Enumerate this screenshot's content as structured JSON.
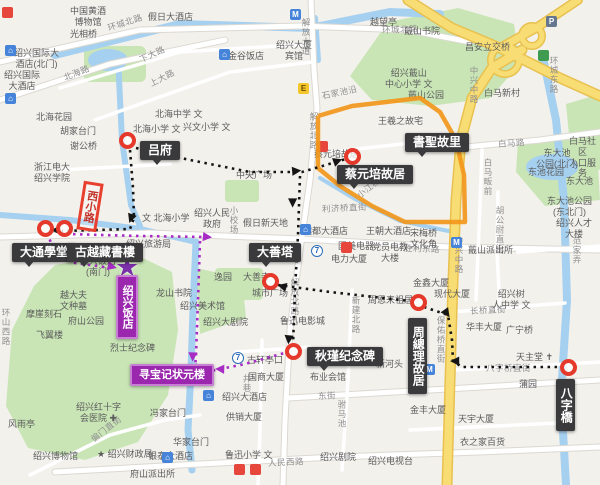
{
  "map": {
    "colors": {
      "land": "#F3F1EC",
      "park": "#C9E5B6",
      "water": "#A6D0F0",
      "road_yellow": "#F8DC74",
      "route_orange": "#F2971B",
      "route_black": "#151515",
      "route_purple": "#A62CC4",
      "marker_red": "#E5392B",
      "label_black_bg": "#3A3A3C",
      "label_purple_bg": "#9A27AE"
    },
    "streets": [
      {
        "t": "环城北路",
        "x": 108,
        "y": 22,
        "r": -18
      },
      {
        "t": "环城北路",
        "x": 382,
        "y": 24,
        "r": -2
      },
      {
        "t": "北海路",
        "x": 64,
        "y": 72,
        "r": -22
      },
      {
        "t": "下大路",
        "x": 140,
        "y": 54,
        "r": -25
      },
      {
        "t": "上大路",
        "x": 150,
        "y": 78,
        "r": -27
      },
      {
        "t": "解放大道",
        "x": 300,
        "y": 18,
        "v": 1
      },
      {
        "t": "解放北路",
        "x": 308,
        "y": 112,
        "v": 1
      },
      {
        "t": "解放北路",
        "x": 289,
        "y": 278,
        "v": 1
      },
      {
        "t": "中兴中路",
        "x": 468,
        "y": 66,
        "v": 1
      },
      {
        "t": "中兴中路",
        "x": 453,
        "y": 236,
        "v": 1
      },
      {
        "t": "环城东路",
        "x": 548,
        "y": 56,
        "v": 1
      },
      {
        "t": "白马路",
        "x": 498,
        "y": 138,
        "r": -4
      },
      {
        "t": "石家池沿",
        "x": 322,
        "y": 90,
        "r": -12
      },
      {
        "t": "小江桥河沿",
        "x": 358,
        "y": 190,
        "r": -38
      },
      {
        "t": "利济桥直街",
        "x": 322,
        "y": 203,
        "r": -3
      },
      {
        "t": "胜利东路",
        "x": 404,
        "y": 242,
        "r": 2
      },
      {
        "t": "东街",
        "x": 318,
        "y": 390,
        "r": -2
      },
      {
        "t": "八字桥直街",
        "x": 486,
        "y": 362,
        "r": 0
      },
      {
        "t": "长桥直街",
        "x": 470,
        "y": 305,
        "r": -3
      },
      {
        "t": "人民西路",
        "x": 268,
        "y": 457,
        "r": -3
      },
      {
        "t": "偏门直街",
        "x": 92,
        "y": 434,
        "r": -38
      },
      {
        "t": "白马畈前",
        "x": 482,
        "y": 158,
        "v": 1
      },
      {
        "t": "胡公尉直街",
        "x": 494,
        "y": 206,
        "v": 1
      },
      {
        "t": "新建北路",
        "x": 350,
        "y": 296,
        "v": 1
      },
      {
        "t": "保佑桥直街",
        "x": 435,
        "y": 316,
        "v": 1
      },
      {
        "t": "井巷",
        "x": 241,
        "y": 374,
        "v": 1
      },
      {
        "t": "小校场",
        "x": 228,
        "y": 206,
        "v": 1
      },
      {
        "t": "环山西路",
        "x": 0,
        "y": 308,
        "v": 1
      },
      {
        "t": "驸马池",
        "x": 336,
        "y": 400,
        "v": 1
      },
      {
        "t": "范家弄",
        "x": 571,
        "y": 236,
        "v": 1
      }
    ],
    "pois": [
      {
        "t": "中国黄酒\n博物馆",
        "x": 70,
        "y": 6
      },
      {
        "t": "假日大酒店",
        "x": 148,
        "y": 12
      },
      {
        "t": "光相桥",
        "x": 70,
        "y": 29
      },
      {
        "t": "绍兴国际大\n酒店(北门)",
        "x": 14,
        "y": 48
      },
      {
        "t": "绍兴国际\n大酒店",
        "x": 4,
        "y": 70
      },
      {
        "t": "北海花园",
        "x": 36,
        "y": 112
      },
      {
        "t": "胡家台门",
        "x": 60,
        "y": 126
      },
      {
        "t": "谢公桥",
        "x": 70,
        "y": 141
      },
      {
        "t": "北海中学 文",
        "x": 155,
        "y": 109
      },
      {
        "t": "北海小学 文",
        "x": 133,
        "y": 124
      },
      {
        "t": "兴文小学 文",
        "x": 183,
        "y": 122
      },
      {
        "t": "浙江电大\n绍兴学院",
        "x": 34,
        "y": 162
      },
      {
        "t": "金谷饭店",
        "x": 228,
        "y": 51
      },
      {
        "t": "绍兴大厦\n宾馆",
        "x": 276,
        "y": 40
      },
      {
        "t": "越望亭",
        "x": 370,
        "y": 17
      },
      {
        "t": "绍兴蕺山\n中心小学 文",
        "x": 385,
        "y": 68
      },
      {
        "t": "蕺山书院",
        "x": 404,
        "y": 26
      },
      {
        "t": "蕺山公园",
        "x": 408,
        "y": 90
      },
      {
        "t": "王羲之故宅",
        "x": 378,
        "y": 116
      },
      {
        "t": "白马新村",
        "x": 484,
        "y": 88
      },
      {
        "t": "昌安立交桥",
        "x": 465,
        "y": 42
      },
      {
        "t": "白马社区\n人口服务",
        "x": 565,
        "y": 136
      },
      {
        "t": "东大池\n公园(北门)",
        "x": 536,
        "y": 148
      },
      {
        "t": "东池花园",
        "x": 528,
        "y": 167
      },
      {
        "t": "东大池",
        "x": 566,
        "y": 176
      },
      {
        "t": "东大池公园\n(东北门)",
        "x": 547,
        "y": 196
      },
      {
        "t": "绍兴人才\n大楼",
        "x": 556,
        "y": 218
      },
      {
        "t": "宋梅桥\n文化角",
        "x": 410,
        "y": 228
      },
      {
        "t": "蕺山派出所",
        "x": 468,
        "y": 245
      },
      {
        "t": "金鑫大厦",
        "x": 413,
        "y": 278
      },
      {
        "t": "现代大厦",
        "x": 434,
        "y": 289
      },
      {
        "t": "绍兴树\n人中学 文",
        "x": 492,
        "y": 289
      },
      {
        "t": "华丰大厦",
        "x": 466,
        "y": 322
      },
      {
        "t": "广宁桥",
        "x": 506,
        "y": 325
      },
      {
        "t": "天主堂 ✝",
        "x": 516,
        "y": 352
      },
      {
        "t": "蒲园",
        "x": 519,
        "y": 379
      },
      {
        "t": "周恩来祖居",
        "x": 368,
        "y": 295
      },
      {
        "t": "王朝大酒店",
        "x": 366,
        "y": 226
      },
      {
        "t": "国美电器",
        "x": 338,
        "y": 241
      },
      {
        "t": "党员电教\n大楼",
        "x": 372,
        "y": 242
      },
      {
        "t": "电力大厦",
        "x": 331,
        "y": 254
      },
      {
        "t": "越都大酒店",
        "x": 303,
        "y": 226
      },
      {
        "t": "假日新天地",
        "x": 243,
        "y": 218
      },
      {
        "t": "中央广场",
        "x": 236,
        "y": 170
      },
      {
        "t": "绍兴人民\n政府",
        "x": 194,
        "y": 208
      },
      {
        "t": "逸园",
        "x": 214,
        "y": 272
      },
      {
        "t": "城市广场",
        "x": 252,
        "y": 288
      },
      {
        "t": "大善寺",
        "x": 243,
        "y": 272
      },
      {
        "t": "鲁迅电影城",
        "x": 280,
        "y": 316
      },
      {
        "t": "绍兴大剧院",
        "x": 203,
        "y": 317
      },
      {
        "t": "国商大厦",
        "x": 248,
        "y": 372
      },
      {
        "t": "古轩亭口",
        "x": 247,
        "y": 355
      },
      {
        "t": "布业会馆",
        "x": 310,
        "y": 372
      },
      {
        "t": "新河头",
        "x": 376,
        "y": 359
      },
      {
        "t": "绍兴大酒店",
        "x": 222,
        "y": 392
      },
      {
        "t": "供销大厦",
        "x": 226,
        "y": 412
      },
      {
        "t": "鲁迅小学 文",
        "x": 225,
        "y": 450
      },
      {
        "t": "绍兴剧院",
        "x": 320,
        "y": 452
      },
      {
        "t": "绍兴电视台",
        "x": 368,
        "y": 456
      },
      {
        "t": "衣之家百货",
        "x": 460,
        "y": 437
      },
      {
        "t": "天宇大厦",
        "x": 458,
        "y": 414
      },
      {
        "t": "金丰大厦",
        "x": 410,
        "y": 405
      },
      {
        "t": "冯家台门",
        "x": 150,
        "y": 408
      },
      {
        "t": "华家台门",
        "x": 173,
        "y": 437
      },
      {
        "t": "绍兴红十字\n会医院 ✚",
        "x": 76,
        "y": 402
      },
      {
        "t": "绍兴博物馆",
        "x": 33,
        "y": 451
      },
      {
        "t": "★ 绍兴财政局",
        "x": 97,
        "y": 449
      },
      {
        "t": "银泰大酒店",
        "x": 148,
        "y": 451
      },
      {
        "t": "府山派出所",
        "x": 130,
        "y": 469
      },
      {
        "t": "风雨亭",
        "x": 8,
        "y": 419
      },
      {
        "t": "烈士纪念碑",
        "x": 110,
        "y": 343
      },
      {
        "t": "飞翼楼",
        "x": 36,
        "y": 330
      },
      {
        "t": "府山公园",
        "x": 68,
        "y": 316
      },
      {
        "t": "越大夫\n文种墓",
        "x": 60,
        "y": 290
      },
      {
        "t": "龙山书院",
        "x": 156,
        "y": 288
      },
      {
        "t": "绍兴美术馆",
        "x": 180,
        "y": 301
      },
      {
        "t": "摩崖刻石",
        "x": 26,
        "y": 309
      },
      {
        "t": "绍兴旅游局",
        "x": 126,
        "y": 239
      },
      {
        "t": "绍兴饭店\n(南门)",
        "x": 80,
        "y": 256
      },
      {
        "t": "蔡元培故居",
        "x": 314,
        "y": 149
      },
      {
        "t": "文 北海小学",
        "x": 142,
        "y": 213
      }
    ],
    "landmarks": [
      {
        "t": "吕府",
        "x": 140,
        "y": 141,
        "k": "black"
      },
      {
        "t": "大通學堂",
        "x": 12,
        "y": 243,
        "k": "black"
      },
      {
        "t": "古越藏書樓",
        "x": 67,
        "y": 243,
        "k": "black"
      },
      {
        "t": "蔡元培故居",
        "x": 337,
        "y": 165,
        "k": "black"
      },
      {
        "t": "書聖故里",
        "x": 405,
        "y": 133,
        "k": "black"
      },
      {
        "t": "大善塔",
        "x": 249,
        "y": 243,
        "k": "black"
      },
      {
        "t": "秋瑾纪念碑",
        "x": 307,
        "y": 347,
        "k": "black"
      },
      {
        "t": "周總理故居",
        "x": 408,
        "y": 318,
        "k": "black",
        "v": 1
      },
      {
        "t": "八字橋",
        "x": 556,
        "y": 379,
        "k": "black",
        "v": 1
      },
      {
        "t": "寻宝记状元楼",
        "x": 130,
        "y": 364,
        "k": "purple"
      },
      {
        "t": "绍兴饭店",
        "x": 116,
        "y": 275,
        "k": "purple",
        "v": 1
      },
      {
        "t": "西小路",
        "x": 80,
        "y": 182,
        "k": "redbox",
        "v": 1
      }
    ],
    "markers": [
      [
        127,
        140
      ],
      [
        45,
        228
      ],
      [
        64,
        228
      ],
      [
        352,
        156
      ],
      [
        270,
        281
      ],
      [
        293,
        351
      ],
      [
        418,
        302
      ],
      [
        568,
        367
      ]
    ],
    "stars": [
      [
        127,
        268
      ],
      [
        196,
        374
      ]
    ],
    "arrows": [
      {
        "x": 57,
        "y": 231,
        "r": 180,
        "c": "b"
      },
      {
        "x": 133,
        "y": 219,
        "r": 110,
        "c": "b"
      },
      {
        "x": 298,
        "y": 170,
        "r": -5,
        "c": "b"
      },
      {
        "x": 339,
        "y": 160,
        "r": -20,
        "c": "b"
      },
      {
        "x": 295,
        "y": 203,
        "r": 90,
        "c": "b"
      },
      {
        "x": 291,
        "y": 340,
        "r": 95,
        "c": "b"
      },
      {
        "x": 283,
        "y": 287,
        "r": 195,
        "c": "b"
      },
      {
        "x": 449,
        "y": 313,
        "r": 55,
        "c": "b"
      },
      {
        "x": 456,
        "y": 362,
        "r": 180,
        "c": "b"
      },
      {
        "x": 209,
        "y": 236,
        "r": 5,
        "c": "p"
      },
      {
        "x": 195,
        "y": 357,
        "r": 92,
        "c": "p"
      },
      {
        "x": 221,
        "y": 370,
        "r": 182,
        "c": "p"
      },
      {
        "x": 114,
        "y": 266,
        "r": 15,
        "c": "p"
      }
    ],
    "icons": [
      {
        "x": 290,
        "y": 9,
        "k": "blue",
        "g": "M"
      },
      {
        "x": 451,
        "y": 237,
        "k": "blue",
        "g": "M"
      },
      {
        "x": 424,
        "y": 364,
        "k": "blue",
        "g": "M"
      },
      {
        "x": 5,
        "y": 45,
        "k": "blue",
        "g": "⌂"
      },
      {
        "x": 5,
        "y": 93,
        "k": "blue",
        "g": "⌂"
      },
      {
        "x": 219,
        "y": 49,
        "k": "blue",
        "g": "⌂"
      },
      {
        "x": 300,
        "y": 224,
        "k": "blue",
        "g": "⌂"
      },
      {
        "x": 203,
        "y": 390,
        "k": "blue",
        "g": "⌂"
      },
      {
        "x": 162,
        "y": 452,
        "k": "blue",
        "g": "⌂"
      },
      {
        "x": 298,
        "y": 83,
        "k": "yellow",
        "g": "E"
      },
      {
        "x": 546,
        "y": 16,
        "k": "gray",
        "g": "P"
      },
      {
        "x": 538,
        "y": 50,
        "k": "green",
        "g": ""
      },
      {
        "x": 2,
        "y": 7,
        "k": "red",
        "g": ""
      },
      {
        "x": 317,
        "y": 141,
        "k": "red",
        "g": ""
      },
      {
        "x": 341,
        "y": 242,
        "k": "red",
        "g": ""
      },
      {
        "x": 234,
        "y": 464,
        "k": "red",
        "g": ""
      },
      {
        "x": 250,
        "y": 464,
        "k": "red",
        "g": ""
      },
      {
        "x": 311,
        "y": 245,
        "k": "bluec",
        "g": "7"
      },
      {
        "x": 232,
        "y": 352,
        "k": "bluec",
        "g": "7"
      }
    ],
    "routes": {
      "orange": [
        [
          318,
          116
        ],
        [
          352,
          106
        ],
        [
          420,
          98
        ],
        [
          440,
          112
        ],
        [
          456,
          140
        ],
        [
          464,
          175
        ],
        [
          465,
          222
        ],
        [
          405,
          222
        ],
        [
          372,
          206
        ],
        [
          340,
          186
        ],
        [
          318,
          168
        ],
        [
          318,
          116
        ]
      ],
      "black": [
        [
          [
            130,
            150
          ],
          [
            133,
            188
          ],
          [
            134,
            218
          ],
          [
            130,
            229
          ],
          [
            62,
            231
          ]
        ],
        [
          [
            136,
            148
          ],
          [
            190,
            160
          ],
          [
            250,
            172
          ],
          [
            302,
            172
          ],
          [
            346,
            159
          ]
        ],
        [
          [
            300,
            176
          ],
          [
            298,
            235
          ],
          [
            295,
            290
          ],
          [
            293,
            345
          ]
        ],
        [
          [
            278,
            285
          ],
          [
            330,
            292
          ],
          [
            410,
            301
          ]
        ],
        [
          [
            424,
            307
          ],
          [
            448,
            315
          ],
          [
            452,
            340
          ],
          [
            453,
            361
          ],
          [
            462,
            367
          ],
          [
            558,
            367
          ]
        ]
      ],
      "purple": [
        [
          [
            66,
            234
          ],
          [
            140,
            236
          ],
          [
            206,
            237
          ]
        ],
        [
          [
            200,
            241
          ],
          [
            198,
            300
          ],
          [
            196,
            355
          ],
          [
            195,
            368
          ]
        ],
        [
          [
            47,
            233
          ],
          [
            54,
            250
          ],
          [
            75,
            263
          ],
          [
            112,
            268
          ]
        ],
        [
          [
            206,
            372
          ],
          [
            245,
            364
          ],
          [
            288,
            352
          ]
        ]
      ]
    }
  }
}
